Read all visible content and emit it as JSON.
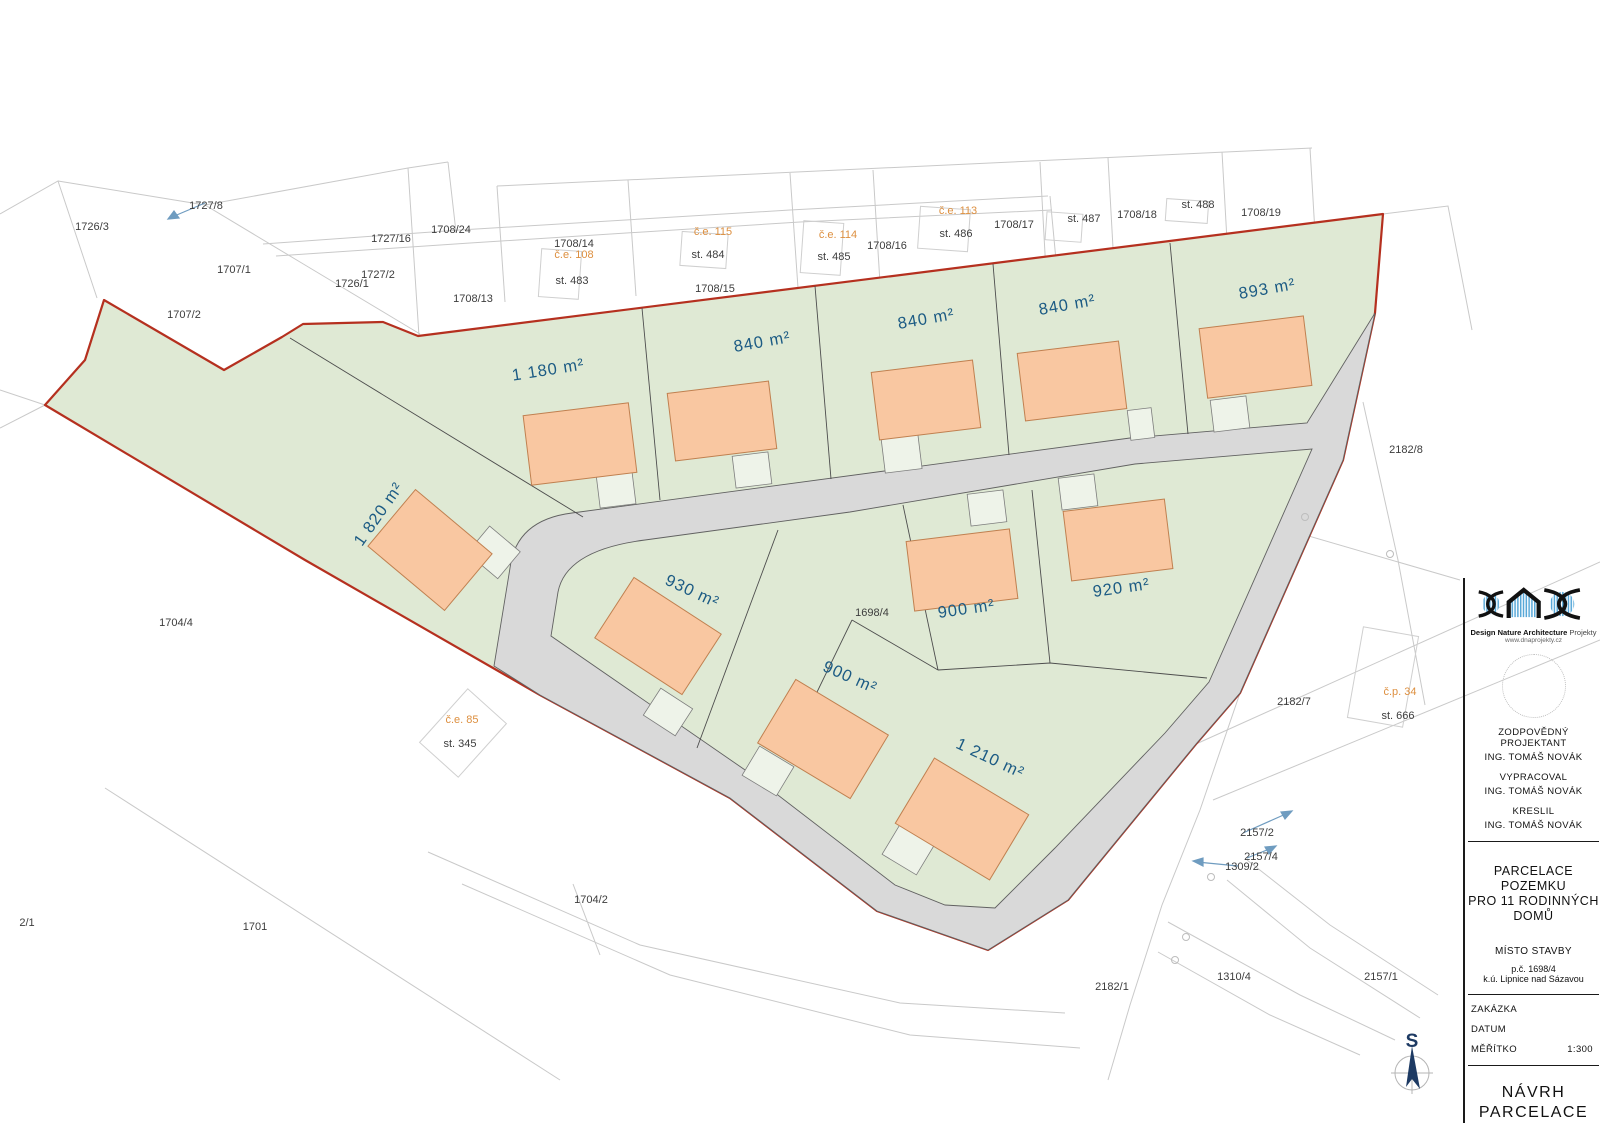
{
  "title_block": {
    "logo": {
      "brand_bold": "Design Nature Architecture",
      "brand_light": "Projekty",
      "website": "www.dnaprojekty.cz"
    },
    "roles": [
      {
        "label": "ZODPOVĚDNÝ PROJEKTANT",
        "value": "ING. TOMÁŠ NOVÁK"
      },
      {
        "label": "VYPRACOVAL",
        "value": "ING. TOMÁŠ NOVÁK"
      },
      {
        "label": "KRESLIL",
        "value": "ING. TOMÁŠ NOVÁK"
      }
    ],
    "project_title": [
      "PARCELACE POZEMKU",
      "PRO 11 RODINNÝCH",
      "DOMŮ"
    ],
    "place": {
      "label": "MÍSTO STAVBY",
      "line1": "p.č. 1698/4",
      "line2": "k.ú. Lipnice nad Sázavou"
    },
    "meta": {
      "order_label": "ZAKÁZKA",
      "date_label": "DATUM",
      "scale_label": "MĚŘÍTKO",
      "scale_value": "1:300"
    },
    "drawing_name": [
      "NÁVRH",
      "PARCELACE"
    ]
  },
  "compass": {
    "north_label": "S"
  },
  "map": {
    "area_labels": [
      {
        "text": "1 180 m²",
        "x": 549,
        "y": 375,
        "rot": -9
      },
      {
        "text": "840 m²",
        "x": 763,
        "y": 347,
        "rot": -10
      },
      {
        "text": "840 m²",
        "x": 927,
        "y": 324,
        "rot": -10
      },
      {
        "text": "840 m²",
        "x": 1068,
        "y": 310,
        "rot": -10
      },
      {
        "text": "893 m²",
        "x": 1268,
        "y": 294,
        "rot": -10
      },
      {
        "text": "1 820 m²",
        "x": 383,
        "y": 517,
        "rot": -55
      },
      {
        "text": "930 m²",
        "x": 690,
        "y": 596,
        "rot": 25
      },
      {
        "text": "900 m²",
        "x": 848,
        "y": 682,
        "rot": 24
      },
      {
        "text": "1 210 m²",
        "x": 988,
        "y": 763,
        "rot": 25
      },
      {
        "text": "900 m²",
        "x": 967,
        "y": 614,
        "rot": -8
      },
      {
        "text": "920 m²",
        "x": 1122,
        "y": 593,
        "rot": -8
      }
    ],
    "parcel_labels": [
      {
        "text": "1726/3",
        "x": 92,
        "y": 230
      },
      {
        "text": "1727/8",
        "x": 206,
        "y": 209
      },
      {
        "text": "1707/1",
        "x": 234,
        "y": 273
      },
      {
        "text": "1727/16",
        "x": 391,
        "y": 242
      },
      {
        "text": "1708/24",
        "x": 451,
        "y": 233
      },
      {
        "text": "1727/2",
        "x": 378,
        "y": 278
      },
      {
        "text": "1726/1",
        "x": 352,
        "y": 287
      },
      {
        "text": "1707/2",
        "x": 184,
        "y": 318
      },
      {
        "text": "1708/13",
        "x": 473,
        "y": 302
      },
      {
        "text": "1708/14",
        "x": 574,
        "y": 247
      },
      {
        "text": "st. 483",
        "x": 572,
        "y": 284
      },
      {
        "text": "st. 484",
        "x": 708,
        "y": 258
      },
      {
        "text": "1708/15",
        "x": 715,
        "y": 292
      },
      {
        "text": "st. 485",
        "x": 834,
        "y": 260
      },
      {
        "text": "1708/16",
        "x": 887,
        "y": 249
      },
      {
        "text": "st. 486",
        "x": 956,
        "y": 237
      },
      {
        "text": "1708/17",
        "x": 1014,
        "y": 228
      },
      {
        "text": "st. 487",
        "x": 1084,
        "y": 222
      },
      {
        "text": "1708/18",
        "x": 1137,
        "y": 218
      },
      {
        "text": "st. 488",
        "x": 1198,
        "y": 208
      },
      {
        "text": "1708/19",
        "x": 1261,
        "y": 216
      },
      {
        "text": "2182/8",
        "x": 1406,
        "y": 453
      },
      {
        "text": "2182/7",
        "x": 1294,
        "y": 705
      },
      {
        "text": "st. 666",
        "x": 1398,
        "y": 719
      },
      {
        "text": "2157/2",
        "x": 1257,
        "y": 836
      },
      {
        "text": "2157/4",
        "x": 1261,
        "y": 860
      },
      {
        "text": "1309/2",
        "x": 1242,
        "y": 870
      },
      {
        "text": "1310/4",
        "x": 1234,
        "y": 980
      },
      {
        "text": "2157/1",
        "x": 1381,
        "y": 980
      },
      {
        "text": "2182/1",
        "x": 1112,
        "y": 990
      },
      {
        "text": "1704/2",
        "x": 591,
        "y": 903
      },
      {
        "text": "1701",
        "x": 255,
        "y": 930
      },
      {
        "text": "2/1",
        "x": 27,
        "y": 926
      },
      {
        "text": "1704/4",
        "x": 176,
        "y": 626
      },
      {
        "text": "st. 345",
        "x": 460,
        "y": 747
      },
      {
        "text": "1698/4",
        "x": 872,
        "y": 616
      }
    ],
    "building_labels": [
      {
        "text": "č.e. 108",
        "x": 574,
        "y": 258
      },
      {
        "text": "č.e. 115",
        "x": 713,
        "y": 235
      },
      {
        "text": "č.e. 114",
        "x": 838,
        "y": 238
      },
      {
        "text": "č.e. 113",
        "x": 958,
        "y": 214
      },
      {
        "text": "č.e. 85",
        "x": 462,
        "y": 723
      },
      {
        "text": "č.p. 34",
        "x": 1400,
        "y": 695
      }
    ]
  },
  "colors": {
    "site_green": "#dfe9d4",
    "boundary_red": "#b5301f",
    "road_gray": "#d9d9d9",
    "driveway": "#eef3e9",
    "house_fill": "#f9c7a1",
    "house_stroke": "#c08050",
    "area_label_blue": "#1c5b84",
    "annotation_orange": "#dd8f3f",
    "ambient_gray": "#c9c9c9"
  }
}
